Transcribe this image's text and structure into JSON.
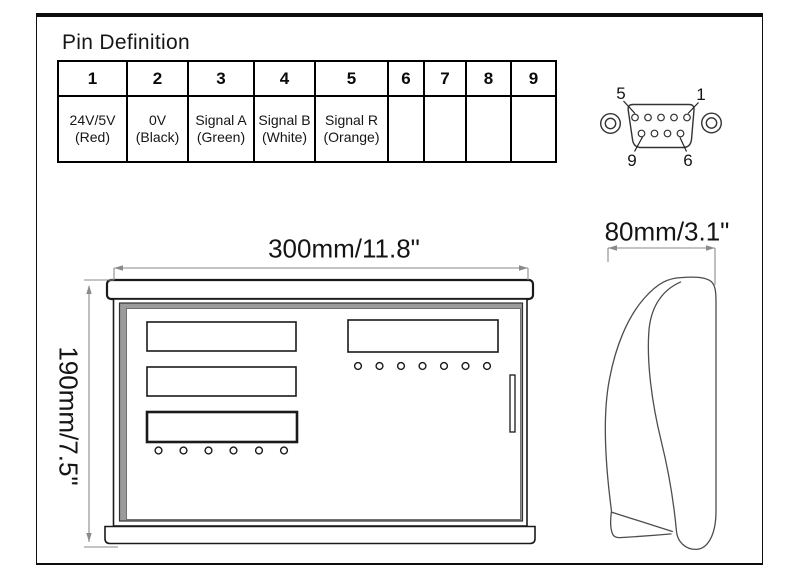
{
  "page": {
    "background_color": "#ffffff",
    "border_color": "#0d0d0d",
    "line_color": "#1a1a1a",
    "dim_line_color": "#8a8a8a"
  },
  "pin_definition": {
    "title": "Pin Definition",
    "columns": [
      {
        "pin": "1",
        "signal": "24V/5V",
        "wire": "(Red)"
      },
      {
        "pin": "2",
        "signal": "0V",
        "wire": "(Black)"
      },
      {
        "pin": "3",
        "signal": "Signal A",
        "wire": "(Green)"
      },
      {
        "pin": "4",
        "signal": "Signal B",
        "wire": "(White)"
      },
      {
        "pin": "5",
        "signal": "Signal R",
        "wire": "(Orange)"
      },
      {
        "pin": "6",
        "signal": "",
        "wire": ""
      },
      {
        "pin": "7",
        "signal": "",
        "wire": ""
      },
      {
        "pin": "8",
        "signal": "",
        "wire": ""
      },
      {
        "pin": "9",
        "signal": "",
        "wire": ""
      }
    ]
  },
  "connector": {
    "pin5_label": "5",
    "pin1_label": "1",
    "pin9_label": "9",
    "pin6_label": "6"
  },
  "front_view": {
    "width_label": "300mm/11.8\"",
    "height_label": "190mm/7.5\""
  },
  "side_view": {
    "width_label": "80mm/3.1\""
  }
}
